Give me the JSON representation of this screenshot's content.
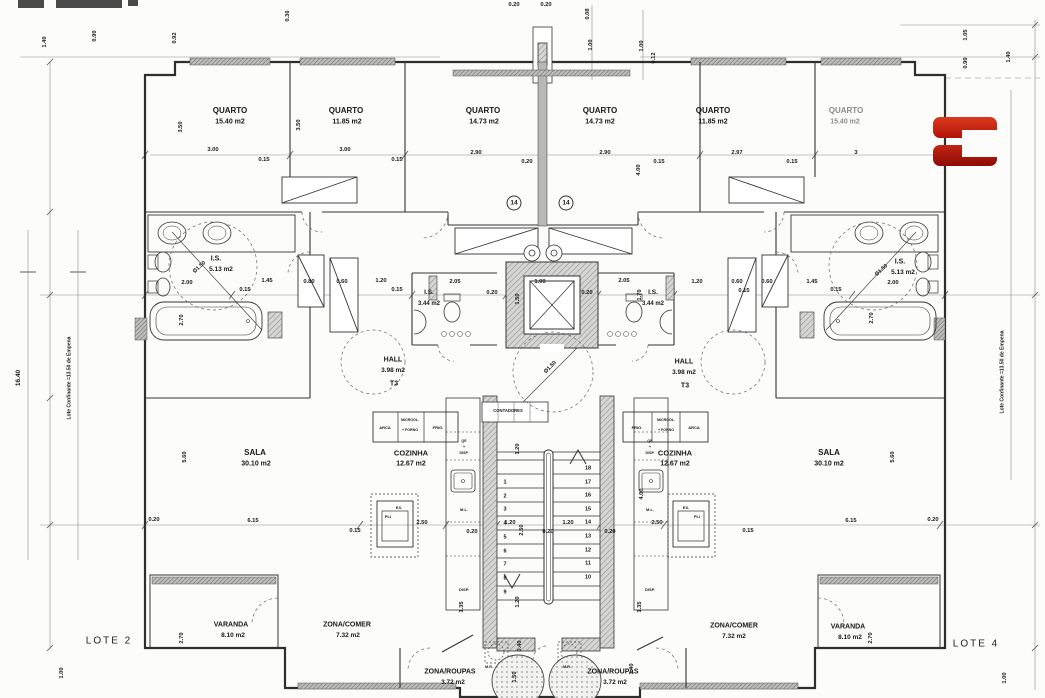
{
  "plan": {
    "lote": {
      "left": "LOTE 2",
      "right": "LOTE 4"
    },
    "stairs": {
      "left": [
        "1",
        "2",
        "3",
        "4",
        "5",
        "6",
        "7",
        "8",
        "9"
      ],
      "right": [
        "18",
        "17",
        "16",
        "15",
        "14",
        "13",
        "12",
        "11",
        "10"
      ]
    },
    "logo": {
      "glyph": "C",
      "color_top": "#cf2a15",
      "color_bottom": "#a31008"
    },
    "labels": [
      {
        "n": "quarto-1-label",
        "t": "QUARTO",
        "x": 230,
        "y": 111,
        "s": 8
      },
      {
        "n": "quarto-1-area",
        "t": "15.40 m2",
        "x": 230,
        "y": 122,
        "s": 7
      },
      {
        "n": "quarto-2-label",
        "t": "QUARTO",
        "x": 346,
        "y": 111,
        "s": 8
      },
      {
        "n": "quarto-2-area",
        "t": "11.85 m2",
        "x": 347,
        "y": 122,
        "s": 7
      },
      {
        "n": "quarto-3-label",
        "t": "QUARTO",
        "x": 483,
        "y": 111,
        "s": 8
      },
      {
        "n": "quarto-3-area",
        "t": "14.73 m2",
        "x": 484,
        "y": 122,
        "s": 7
      },
      {
        "n": "quarto-4-label",
        "t": "QUARTO",
        "x": 600,
        "y": 111,
        "s": 8
      },
      {
        "n": "quarto-4-area",
        "t": "14.73 m2",
        "x": 600,
        "y": 122,
        "s": 7
      },
      {
        "n": "quarto-5-label",
        "t": "QUARTO",
        "x": 713,
        "y": 111,
        "s": 8
      },
      {
        "n": "quarto-5-area",
        "t": "11.85 m2",
        "x": 713,
        "y": 122,
        "s": 7
      },
      {
        "n": "quarto-6-label",
        "t": "QUARTO",
        "x": 846,
        "y": 111,
        "s": 8,
        "o": 0.5
      },
      {
        "n": "quarto-6-area",
        "t": "15.40 m2",
        "x": 845,
        "y": 122,
        "s": 7,
        "o": 0.5
      },
      {
        "n": "is-left-label",
        "t": "I.S.",
        "x": 216,
        "y": 259,
        "s": 7
      },
      {
        "n": "is-left-area",
        "t": "5.13 m2",
        "x": 221,
        "y": 270,
        "s": 6.5
      },
      {
        "n": "is-left-diameter",
        "t": "Ø1.50",
        "x": 200,
        "y": 268,
        "r": -42,
        "s": 5.5
      },
      {
        "n": "is-right-label",
        "t": "I.S.",
        "x": 900,
        "y": 262,
        "s": 7
      },
      {
        "n": "is-right-area",
        "t": "5.13 m2",
        "x": 903,
        "y": 273,
        "s": 6.5
      },
      {
        "n": "is-right-diameter",
        "t": "Ø1.50",
        "x": 882,
        "y": 271,
        "r": -42,
        "s": 5.5
      },
      {
        "n": "is2-left-label",
        "t": "I.S.",
        "x": 429,
        "y": 293,
        "s": 6.5
      },
      {
        "n": "is2-left-area",
        "t": "3.44 m2",
        "x": 429,
        "y": 304,
        "s": 6
      },
      {
        "n": "is2-right-label",
        "t": "I.S.",
        "x": 653,
        "y": 293,
        "s": 6.5
      },
      {
        "n": "is2-right-area",
        "t": "3.44 m2",
        "x": 653,
        "y": 304,
        "s": 6
      },
      {
        "n": "hall-left-label",
        "t": "HALL",
        "x": 393,
        "y": 360,
        "s": 7
      },
      {
        "n": "hall-left-area",
        "t": "3.98 m2",
        "x": 393,
        "y": 371,
        "s": 6.5
      },
      {
        "n": "hall-left-type",
        "t": "T3",
        "x": 394,
        "y": 384,
        "s": 7
      },
      {
        "n": "hall-right-label",
        "t": "HALL",
        "x": 684,
        "y": 362,
        "s": 7
      },
      {
        "n": "hall-right-area",
        "t": "3.98 m2",
        "x": 684,
        "y": 373,
        "s": 6.5
      },
      {
        "n": "hall-right-type",
        "t": "T3",
        "x": 685,
        "y": 386,
        "s": 7
      },
      {
        "n": "sala-left-label",
        "t": "SALA",
        "x": 255,
        "y": 453,
        "s": 8
      },
      {
        "n": "sala-left-area",
        "t": "30.10 m2",
        "x": 256,
        "y": 464,
        "s": 7
      },
      {
        "n": "sala-right-label",
        "t": "SALA",
        "x": 829,
        "y": 453,
        "s": 8
      },
      {
        "n": "sala-right-area",
        "t": "30.10 m2",
        "x": 829,
        "y": 464,
        "s": 7
      },
      {
        "n": "cozinha-left-label",
        "t": "COZINHA",
        "x": 411,
        "y": 453,
        "s": 7.5
      },
      {
        "n": "cozinha-left-area",
        "t": "12.67 m2",
        "x": 411,
        "y": 464,
        "s": 7
      },
      {
        "n": "cozinha-right-label",
        "t": "COZINHA",
        "x": 675,
        "y": 453,
        "s": 7.5
      },
      {
        "n": "cozinha-right-area",
        "t": "12.67 m2",
        "x": 675,
        "y": 464,
        "s": 7
      },
      {
        "n": "contadores-label",
        "t": "CONTADORES",
        "x": 508,
        "y": 411,
        "s": 4.2
      },
      {
        "n": "arca-left-label",
        "t": "ARCA",
        "x": 385,
        "y": 428,
        "s": 4
      },
      {
        "n": "microwave-left-label",
        "t": "MICROOL.",
        "x": 410,
        "y": 421,
        "s": 3.6
      },
      {
        "n": "microwave-left-label2",
        "t": "+ FORNO",
        "x": 410,
        "y": 431,
        "s": 3.6
      },
      {
        "n": "frig-left-label",
        "t": "FRIG.",
        "x": 438,
        "y": 428,
        "s": 4
      },
      {
        "n": "frig-right-label",
        "t": "FRIG.",
        "x": 637,
        "y": 428,
        "s": 4
      },
      {
        "n": "microwave-right-label",
        "t": "MICROOL.",
        "x": 666,
        "y": 421,
        "s": 3.6
      },
      {
        "n": "microwave-right-label2",
        "t": "+ FORNO",
        "x": 666,
        "y": 431,
        "s": 3.6
      },
      {
        "n": "arca-right-label",
        "t": "ARCA",
        "x": 694,
        "y": 428,
        "s": 4
      },
      {
        "n": "exaustor-left-label",
        "t": "EX.",
        "x": 399,
        "y": 508,
        "s": 4
      },
      {
        "n": "placa-left-label",
        "t": "PLI",
        "x": 388,
        "y": 517,
        "s": 4
      },
      {
        "n": "exaustor-right-label",
        "t": "EX.",
        "x": 686,
        "y": 508,
        "s": 4
      },
      {
        "n": "placa-right-label",
        "t": "PLI",
        "x": 697,
        "y": 517,
        "s": 4
      },
      {
        "n": "qe-disp-left-label",
        "t": "QE",
        "x": 464,
        "y": 442,
        "s": 3.6
      },
      {
        "n": "qe-disp-left-label2",
        "t": "+",
        "x": 464,
        "y": 448,
        "s": 3.6
      },
      {
        "n": "qe-disp-left-label3",
        "t": "DISP.",
        "x": 464,
        "y": 454,
        "s": 3.6
      },
      {
        "n": "ml-left-label",
        "t": "M.L.",
        "x": 464,
        "y": 510,
        "s": 4
      },
      {
        "n": "disp-left-label",
        "t": "DISP.",
        "x": 464,
        "y": 590,
        "s": 4
      },
      {
        "n": "qe-disp-right-label",
        "t": "QE",
        "x": 650,
        "y": 442,
        "s": 3.6
      },
      {
        "n": "qe-disp-right-label2",
        "t": "+",
        "x": 650,
        "y": 448,
        "s": 3.6
      },
      {
        "n": "qe-disp-right-label3",
        "t": "DISP.",
        "x": 650,
        "y": 454,
        "s": 3.6
      },
      {
        "n": "ml-right-label",
        "t": "M.L.",
        "x": 650,
        "y": 510,
        "s": 4
      },
      {
        "n": "disp-right-label",
        "t": "DISP.",
        "x": 650,
        "y": 590,
        "s": 4
      },
      {
        "n": "mr-left-label",
        "t": "M.R.",
        "x": 489,
        "y": 668,
        "s": 3.8
      },
      {
        "n": "mr-right-label",
        "t": "M.R.",
        "x": 567,
        "y": 668,
        "s": 3.8
      },
      {
        "n": "roupas-left-label",
        "t": "ZONA/ROUPAS",
        "x": 450,
        "y": 672,
        "s": 7
      },
      {
        "n": "roupas-left-area",
        "t": "3.72 m2",
        "x": 453,
        "y": 683,
        "s": 6.5
      },
      {
        "n": "roupas-right-label",
        "t": "ZONA/ROUPAS",
        "x": 613,
        "y": 672,
        "s": 7
      },
      {
        "n": "roupas-right-area",
        "t": "3.72 m2",
        "x": 615,
        "y": 683,
        "s": 6.5
      },
      {
        "n": "comer-left-label",
        "t": "ZONA/COMER",
        "x": 347,
        "y": 625,
        "s": 7
      },
      {
        "n": "comer-left-area",
        "t": "7.32 m2",
        "x": 348,
        "y": 636,
        "s": 6.5
      },
      {
        "n": "comer-right-label",
        "t": "ZONA/COMER",
        "x": 734,
        "y": 626,
        "s": 7
      },
      {
        "n": "comer-right-area",
        "t": "7.32 m2",
        "x": 734,
        "y": 637,
        "s": 6.5
      },
      {
        "n": "varanda-left-label",
        "t": "VARANDA",
        "x": 231,
        "y": 625,
        "s": 7
      },
      {
        "n": "varanda-left-area",
        "t": "8.10 m2",
        "x": 233,
        "y": 636,
        "s": 6.5
      },
      {
        "n": "varanda-right-label",
        "t": "VARANDA",
        "x": 848,
        "y": 627,
        "s": 7
      },
      {
        "n": "varanda-right-area",
        "t": "8.10 m2",
        "x": 850,
        "y": 638,
        "s": 6.5
      },
      {
        "n": "note-14-left",
        "t": "14",
        "x": 514,
        "y": 203,
        "s": 6.5,
        "circ": true
      },
      {
        "n": "note-14-right",
        "t": "14",
        "x": 566,
        "y": 203,
        "s": 6.5,
        "circ": true
      },
      {
        "n": "boundary-note-left",
        "t": "Lote Confinante =13.50 de Empena",
        "x": 70,
        "y": 378,
        "r": -90,
        "s": 5
      },
      {
        "n": "boundary-note-right",
        "t": "Lote Confinante =13.50 de Empena",
        "x": 1003,
        "y": 372,
        "r": -90,
        "s": 5
      },
      {
        "n": "dim-label",
        "t": "16.40",
        "x": 19,
        "y": 378,
        "r": -90,
        "s": 6.5
      },
      {
        "n": "dim-label",
        "t": "1.40",
        "x": 46,
        "y": 42,
        "r": -90
      },
      {
        "n": "dim-label",
        "t": "0.90",
        "x": 96,
        "y": 36,
        "r": -90
      },
      {
        "n": "dim-label",
        "t": "0.92",
        "x": 176,
        "y": 38,
        "r": -90
      },
      {
        "n": "dim-label",
        "t": "0.36",
        "x": 289,
        "y": 16,
        "r": -90
      },
      {
        "n": "dim-label",
        "t": "0.20",
        "x": 514,
        "y": 6
      },
      {
        "n": "dim-label",
        "t": "0.20",
        "x": 546,
        "y": 6
      },
      {
        "n": "dim-label",
        "t": "0.08",
        "x": 589,
        "y": 14,
        "r": -90
      },
      {
        "n": "dim-label",
        "t": "1.00",
        "x": 592,
        "y": 45,
        "r": -90
      },
      {
        "n": "dim-label",
        "t": "1.00",
        "x": 643,
        "y": 46,
        "r": -90
      },
      {
        "n": "dim-label",
        "t": "0.12",
        "x": 655,
        "y": 58,
        "r": -90
      },
      {
        "n": "dim-label",
        "t": "1.05",
        "x": 967,
        "y": 35,
        "r": -90
      },
      {
        "n": "dim-label",
        "t": "0.90",
        "x": 967,
        "y": 63,
        "r": -90
      },
      {
        "n": "dim-label",
        "t": "1.40",
        "x": 1010,
        "y": 57,
        "r": -90
      },
      {
        "n": "dim-label",
        "t": "3.00",
        "x": 213,
        "y": 151
      },
      {
        "n": "dim-label",
        "t": "0.15",
        "x": 264,
        "y": 161
      },
      {
        "n": "dim-label",
        "t": "3.00",
        "x": 345,
        "y": 151
      },
      {
        "n": "dim-label",
        "t": "0.15",
        "x": 397,
        "y": 161
      },
      {
        "n": "dim-label",
        "t": "2.90",
        "x": 476,
        "y": 154
      },
      {
        "n": "dim-label",
        "t": "0.20",
        "x": 527,
        "y": 163
      },
      {
        "n": "dim-label",
        "t": "2.90",
        "x": 605,
        "y": 154
      },
      {
        "n": "dim-label",
        "t": "0.15",
        "x": 659,
        "y": 163
      },
      {
        "n": "dim-label",
        "t": "2.97",
        "x": 737,
        "y": 154
      },
      {
        "n": "dim-label",
        "t": "0.15",
        "x": 792,
        "y": 163
      },
      {
        "n": "dim-label",
        "t": "3",
        "x": 856,
        "y": 154
      },
      {
        "n": "dim-label",
        "t": "3.50",
        "x": 182,
        "y": 127,
        "r": -90
      },
      {
        "n": "dim-label",
        "t": "3.50",
        "x": 300,
        "y": 125,
        "r": -90
      },
      {
        "n": "dim-label",
        "t": "4.00",
        "x": 640,
        "y": 170,
        "r": -90
      },
      {
        "n": "dim-label",
        "t": "2.00",
        "x": 187,
        "y": 284
      },
      {
        "n": "dim-label",
        "t": "0.15",
        "x": 245,
        "y": 291
      },
      {
        "n": "dim-label",
        "t": "1.45",
        "x": 267,
        "y": 282
      },
      {
        "n": "dim-label",
        "t": "0.80",
        "x": 309,
        "y": 283
      },
      {
        "n": "dim-label",
        "t": "0.60",
        "x": 342,
        "y": 283
      },
      {
        "n": "dim-label",
        "t": "1.20",
        "x": 381,
        "y": 282
      },
      {
        "n": "dim-label",
        "t": "0.15",
        "x": 397,
        "y": 291
      },
      {
        "n": "dim-label",
        "t": "2.05",
        "x": 455,
        "y": 283
      },
      {
        "n": "dim-label",
        "t": "0.20",
        "x": 492,
        "y": 294
      },
      {
        "n": "dim-label",
        "t": "1.00",
        "x": 540,
        "y": 283
      },
      {
        "n": "dim-label",
        "t": "1.50",
        "x": 519,
        "y": 299,
        "r": -90
      },
      {
        "n": "dim-label",
        "t": "0.20",
        "x": 587,
        "y": 294
      },
      {
        "n": "dim-label",
        "t": "2.05",
        "x": 624,
        "y": 282
      },
      {
        "n": "dim-label",
        "t": "1.70",
        "x": 641,
        "y": 295,
        "r": -90
      },
      {
        "n": "dim-label",
        "t": "Ø1.50",
        "x": 551,
        "y": 368,
        "r": -45,
        "s": 5.5
      },
      {
        "n": "dim-label",
        "t": "1.20",
        "x": 697,
        "y": 283
      },
      {
        "n": "dim-label",
        "t": "0.60",
        "x": 737,
        "y": 283
      },
      {
        "n": "dim-label",
        "t": "0.15",
        "x": 744,
        "y": 292
      },
      {
        "n": "dim-label",
        "t": "0.60",
        "x": 767,
        "y": 283
      },
      {
        "n": "dim-label",
        "t": "1.45",
        "x": 812,
        "y": 283
      },
      {
        "n": "dim-label",
        "t": "0.15",
        "x": 836,
        "y": 291
      },
      {
        "n": "dim-label",
        "t": "2.00",
        "x": 893,
        "y": 284
      },
      {
        "n": "dim-label",
        "t": "2.70",
        "x": 183,
        "y": 320,
        "r": -90
      },
      {
        "n": "dim-label",
        "t": "2.70",
        "x": 873,
        "y": 318,
        "r": -90
      },
      {
        "n": "dim-label",
        "t": "0.20",
        "x": 154,
        "y": 521
      },
      {
        "n": "dim-label",
        "t": "6.15",
        "x": 253,
        "y": 522
      },
      {
        "n": "dim-label",
        "t": "0.15",
        "x": 355,
        "y": 532
      },
      {
        "n": "dim-label",
        "t": "2.50",
        "x": 422,
        "y": 524
      },
      {
        "n": "dim-label",
        "t": "0.20",
        "x": 472,
        "y": 533
      },
      {
        "n": "dim-label",
        "t": "1.20",
        "x": 510,
        "y": 524
      },
      {
        "n": "dim-label",
        "t": "2.50",
        "x": 523,
        "y": 530,
        "r": -90
      },
      {
        "n": "dim-label",
        "t": "0.20",
        "x": 548,
        "y": 533
      },
      {
        "n": "dim-label",
        "t": "1.20",
        "x": 568,
        "y": 524
      },
      {
        "n": "dim-label",
        "t": "0.20",
        "x": 610,
        "y": 533
      },
      {
        "n": "dim-label",
        "t": "2.50",
        "x": 657,
        "y": 524
      },
      {
        "n": "dim-label",
        "t": "0.15",
        "x": 748,
        "y": 532
      },
      {
        "n": "dim-label",
        "t": "6.15",
        "x": 851,
        "y": 522
      },
      {
        "n": "dim-label",
        "t": "0.20",
        "x": 933,
        "y": 521
      },
      {
        "n": "dim-label",
        "t": "5.60",
        "x": 186,
        "y": 457,
        "r": -90
      },
      {
        "n": "dim-label",
        "t": "5.60",
        "x": 894,
        "y": 457,
        "r": -90
      },
      {
        "n": "dim-label",
        "t": "4.00",
        "x": 643,
        "y": 494,
        "r": -90
      },
      {
        "n": "dim-label",
        "t": "1.20",
        "x": 519,
        "y": 449,
        "r": -90
      },
      {
        "n": "dim-label",
        "t": "1.20",
        "x": 519,
        "y": 602,
        "r": -90
      },
      {
        "n": "dim-label",
        "t": "1.35",
        "x": 463,
        "y": 607,
        "r": -90
      },
      {
        "n": "dim-label",
        "t": "1.35",
        "x": 641,
        "y": 607,
        "r": -90
      },
      {
        "n": "dim-label",
        "t": "2.70",
        "x": 183,
        "y": 638,
        "r": -90
      },
      {
        "n": "dim-label",
        "t": "2.70",
        "x": 872,
        "y": 638,
        "r": -90
      },
      {
        "n": "dim-label",
        "t": "0.40",
        "x": 521,
        "y": 646,
        "r": -90
      },
      {
        "n": "dim-label",
        "t": "1.50",
        "x": 516,
        "y": 677,
        "r": -90
      },
      {
        "n": "dim-label",
        "t": "1.40",
        "x": 633,
        "y": 669,
        "r": -90
      },
      {
        "n": "dim-label",
        "t": "1.00",
        "x": 63,
        "y": 673,
        "r": -90
      },
      {
        "n": "dim-label",
        "t": "1.00",
        "x": 1006,
        "y": 678,
        "r": -90
      }
    ]
  }
}
